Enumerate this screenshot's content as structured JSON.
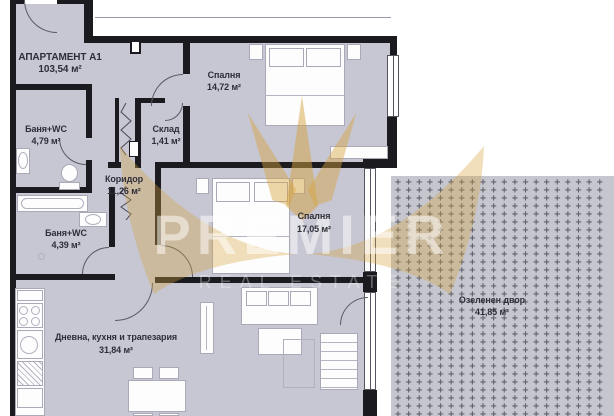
{
  "plan": {
    "apartment": {
      "name": "АПАРТАМЕНТ А1",
      "area": "103,54 м²"
    },
    "rooms": [
      {
        "key": "bath1",
        "name": "Баня+WC",
        "area": "4,79 м²"
      },
      {
        "key": "storage",
        "name": "Склад",
        "area": "1,41 м²"
      },
      {
        "key": "bedroom1",
        "name": "Спалня",
        "area": "14,72 м²"
      },
      {
        "key": "corridor",
        "name": "Коридор",
        "area": "11,26 м²"
      },
      {
        "key": "bath2",
        "name": "Баня+WC",
        "area": "4,39 м²"
      },
      {
        "key": "bedroom2",
        "name": "Спалня",
        "area": "17,05 м²"
      },
      {
        "key": "living",
        "name": "Дневна, кухня и трапезария",
        "area": "31,84 м²"
      },
      {
        "key": "yard",
        "name": "Озеленен двор",
        "area": "41,85 м²"
      }
    ]
  },
  "watermark": {
    "brand": "PREMIER",
    "tagline": "REAL ESTATE"
  },
  "colors": {
    "wall": "#1b1b1f",
    "floor": "#c7c7d3",
    "yard": "#c6c6ce",
    "yard_mark": "#65656f",
    "gold": "#d6a33f",
    "label": "#2e2e38"
  }
}
